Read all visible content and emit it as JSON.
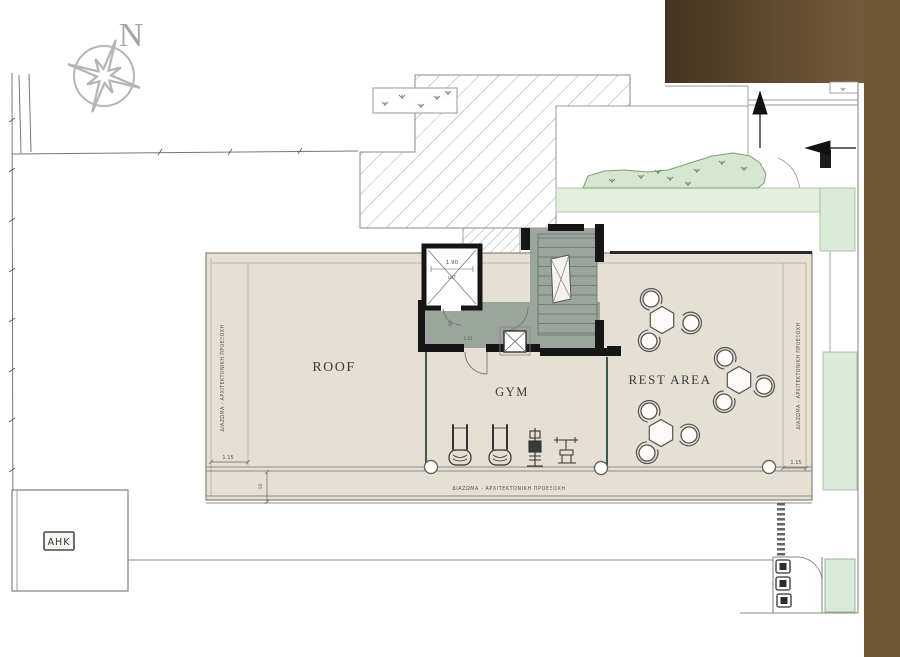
{
  "plan": {
    "compass": {
      "label": "N"
    },
    "rooms": {
      "roof": "ROOF",
      "gym": "GYM",
      "rest": "REST AREA"
    },
    "core": {
      "lift_label": "LIFT",
      "lift_width": "1.90",
      "door_width": ".95",
      "corridor_width": "2.15"
    },
    "edges": {
      "note": "ΔΙΑΖΩΜΑ - ΑΡΧΙΤΕΚΤΟΝΙΚΗ ΠΡΟΕΞΟΧΗ",
      "offset_left": "1.15",
      "offset_right": "1.15",
      "band_depth": ".50"
    },
    "utility": {
      "ahk": "AHK"
    },
    "colors": {
      "terrace": "#e5dfd4",
      "core_floor": "#9aa59b",
      "landscape": "#d5e7cf",
      "planting_band": "#e3eedd",
      "glass": "#3c5a50",
      "brown_dark": "#46341f",
      "brown_light": "#7e6243",
      "brown_strip": "#6f5636"
    }
  }
}
